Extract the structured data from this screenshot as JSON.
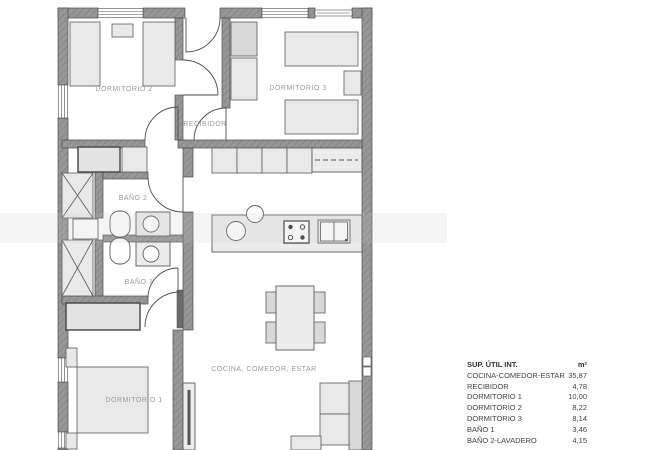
{
  "plan": {
    "rooms": {
      "dormitorio2": "DORMITORIO 2",
      "dormitorio3": "DORMITORIO 3",
      "recibidor": "RECIBIDOR",
      "bano2": "BAÑO 2",
      "bano1": "BAÑO 1",
      "dormitorio1": "DORMITORIO 1",
      "cocina": "COCINA, COMEDOR, ESTAR"
    }
  },
  "table": {
    "header": {
      "name": "SUP. ÚTIL INT.",
      "unit": "m²"
    },
    "rows": [
      {
        "name": "COCINA-COMEDOR-ESTAR",
        "value": "35,87"
      },
      {
        "name": "RECIBIDOR",
        "value": "4,78"
      },
      {
        "name": "DORMITORIO 1",
        "value": "10,00"
      },
      {
        "name": "DORMITORIO 2",
        "value": "8,22"
      },
      {
        "name": "DORMITORIO 3",
        "value": "8,14"
      },
      {
        "name": "BAÑO 1",
        "value": "3,46"
      },
      {
        "name": "BAÑO 2-LAVADERO",
        "value": "4,15"
      }
    ]
  },
  "colors": {
    "wall": "#969696",
    "wall_outline": "#4d4d4d",
    "furniture_fill": "#e9e9e9",
    "label_gray": "#9a9a9a",
    "table_text": "#414141",
    "background": "#ffffff"
  }
}
